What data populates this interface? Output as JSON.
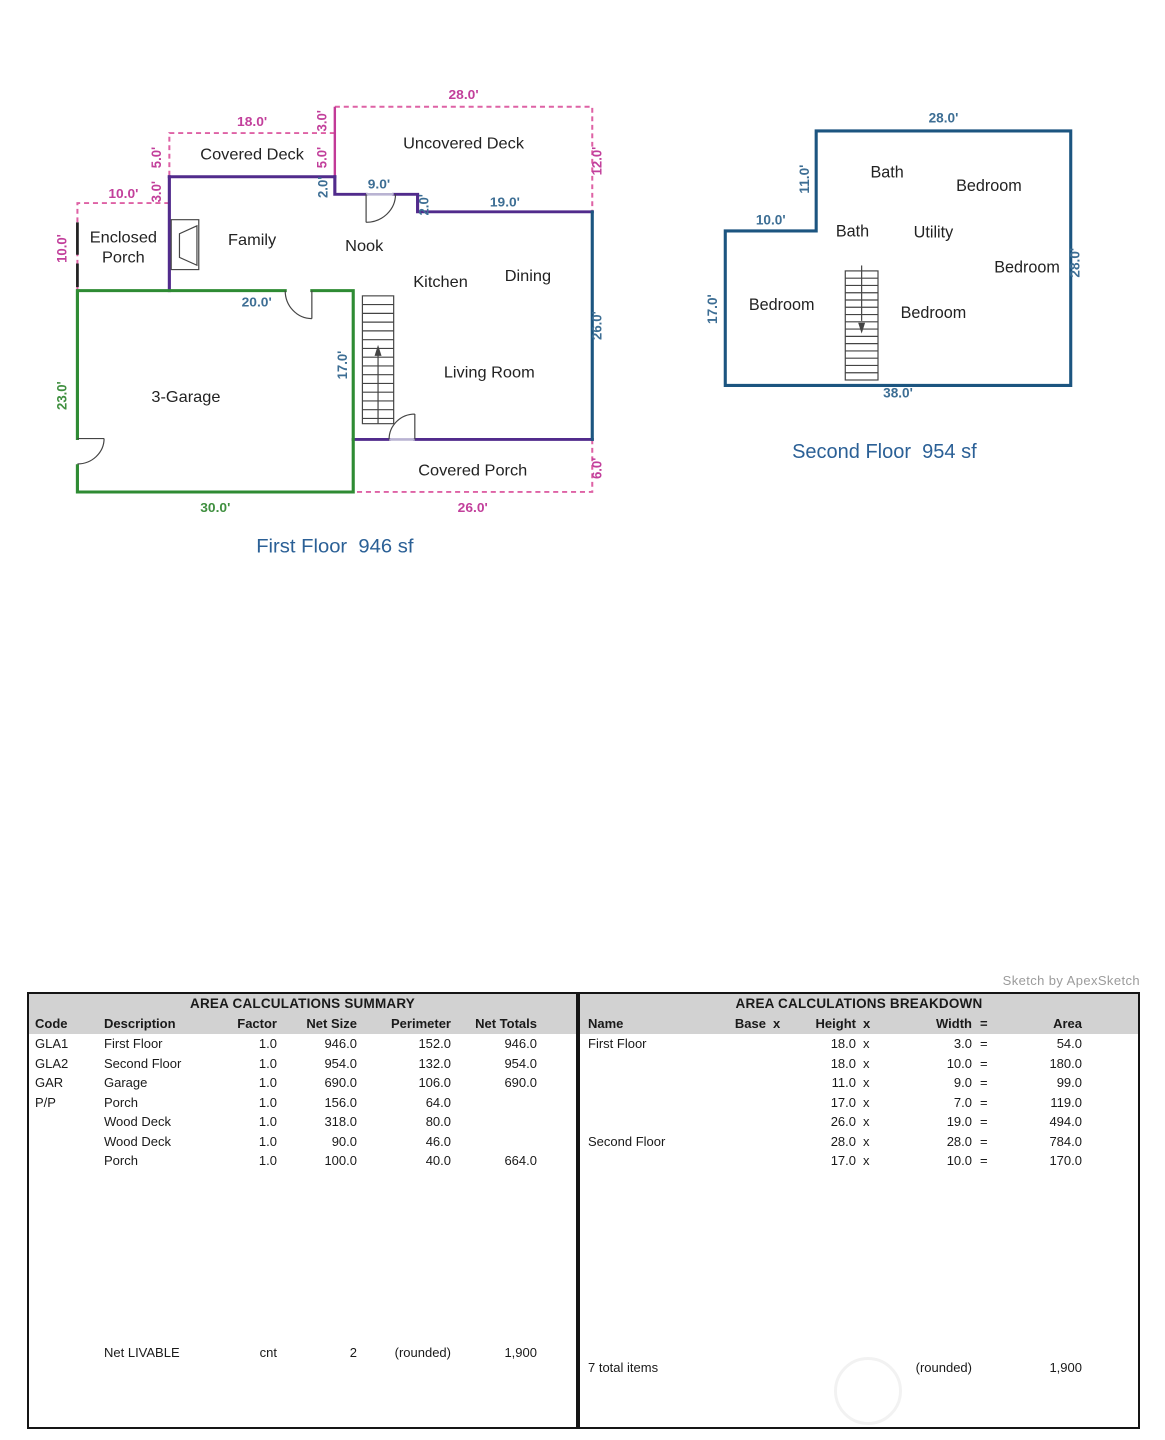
{
  "watermark_text": "Sketch by ApexSketch",
  "colors": {
    "wall_purple": "#512b8c",
    "wall_blue": "#1c5580",
    "wall_green": "#2e8b33",
    "deck_pink": "#de62a5",
    "dim_pink": "#c23f9b",
    "dim_blue": "#3d6e94",
    "dim_green": "#3f8f3f",
    "title_blue": "#2b6096",
    "header_gray": "#d2d2d2"
  },
  "first_floor": {
    "title": "First Floor  946 sf",
    "rooms": {
      "covered_deck": "Covered Deck",
      "uncovered_deck": "Uncovered Deck",
      "enclosed_porch_1": "Enclosed",
      "enclosed_porch_2": "Porch",
      "family": "Family",
      "nook": "Nook",
      "kitchen": "Kitchen",
      "dining": "Dining",
      "living_room": "Living Room",
      "garage": "3-Garage",
      "covered_porch": "Covered Porch"
    },
    "dims": {
      "deck_top": "28.0'",
      "covered_deck_top": "18.0'",
      "step3_right": "3.0'",
      "deck_side5_right": "5.0'",
      "deck_side5_left": "5.0'",
      "step3_left": "3.0'",
      "porch_top": "10.0'",
      "porch_left": "10.0'",
      "deck_right": "12.0'",
      "nook_step_left": "2.0'",
      "nook_opening": "9.0'",
      "nook_step_right": "2.0'",
      "kitchen_top": "19.0'",
      "right_wall": "26.0'",
      "garage_top": "20.0'",
      "stair_wall": "17.0'",
      "garage_left": "23.0'",
      "garage_bottom": "30.0'",
      "porch_bottom": "26.0'",
      "porch_right": "6.0'"
    }
  },
  "second_floor": {
    "title": "Second Floor  954 sf",
    "rooms": {
      "bath_top": "Bath",
      "bedroom_tr": "Bedroom",
      "bath_mid": "Bath",
      "utility": "Utility",
      "bedroom_right": "Bedroom",
      "bedroom_left": "Bedroom",
      "bedroom_center": "Bedroom"
    },
    "dims": {
      "top": "28.0'",
      "upper_left": "11.0'",
      "left_step": "10.0'",
      "left": "17.0'",
      "right": "28.0'",
      "bottom": "38.0'"
    }
  },
  "summary_table": {
    "title": "AREA CALCULATIONS SUMMARY",
    "headers": {
      "code": "Code",
      "description": "Description",
      "factor": "Factor",
      "net_size": "Net Size",
      "perimeter": "Perimeter",
      "net_totals": "Net Totals"
    },
    "rows": [
      {
        "code": "GLA1",
        "description": "First Floor",
        "factor": "1.0",
        "net_size": "946.0",
        "perimeter": "152.0",
        "net_totals": "946.0"
      },
      {
        "code": "GLA2",
        "description": "Second Floor",
        "factor": "1.0",
        "net_size": "954.0",
        "perimeter": "132.0",
        "net_totals": "954.0"
      },
      {
        "code": "GAR",
        "description": "Garage",
        "factor": "1.0",
        "net_size": "690.0",
        "perimeter": "106.0",
        "net_totals": "690.0"
      },
      {
        "code": "P/P",
        "description": "Porch",
        "factor": "1.0",
        "net_size": "156.0",
        "perimeter": "64.0",
        "net_totals": ""
      },
      {
        "code": "",
        "description": "Wood Deck",
        "factor": "1.0",
        "net_size": "318.0",
        "perimeter": "80.0",
        "net_totals": ""
      },
      {
        "code": "",
        "description": "Wood Deck",
        "factor": "1.0",
        "net_size": "90.0",
        "perimeter": "46.0",
        "net_totals": ""
      },
      {
        "code": "",
        "description": "Porch",
        "factor": "1.0",
        "net_size": "100.0",
        "perimeter": "40.0",
        "net_totals": "664.0"
      }
    ],
    "footer": {
      "label": "Net LIVABLE",
      "cnt": "cnt",
      "count": "2",
      "rounded": "(rounded)",
      "total": "1,900"
    }
  },
  "breakdown_table": {
    "title": "AREA CALCULATIONS BREAKDOWN",
    "headers": {
      "name": "Name",
      "base": "Base",
      "x1": "x",
      "height": "Height",
      "x2": "x",
      "width": "Width",
      "eq": "=",
      "area": "Area"
    },
    "rows": [
      {
        "name": "First Floor",
        "height": "18.0",
        "x": "x",
        "width": "3.0",
        "eq": "=",
        "area": "54.0"
      },
      {
        "name": "",
        "height": "18.0",
        "x": "x",
        "width": "10.0",
        "eq": "=",
        "area": "180.0"
      },
      {
        "name": "",
        "height": "11.0",
        "x": "x",
        "width": "9.0",
        "eq": "=",
        "area": "99.0"
      },
      {
        "name": "",
        "height": "17.0",
        "x": "x",
        "width": "7.0",
        "eq": "=",
        "area": "119.0"
      },
      {
        "name": "",
        "height": "26.0",
        "x": "x",
        "width": "19.0",
        "eq": "=",
        "area": "494.0"
      },
      {
        "name": "Second Floor",
        "height": "28.0",
        "x": "x",
        "width": "28.0",
        "eq": "=",
        "area": "784.0"
      },
      {
        "name": "",
        "height": "17.0",
        "x": "x",
        "width": "10.0",
        "eq": "=",
        "area": "170.0"
      }
    ],
    "footer": {
      "items": "7 total items",
      "rounded": "(rounded)",
      "total": "1,900"
    }
  }
}
